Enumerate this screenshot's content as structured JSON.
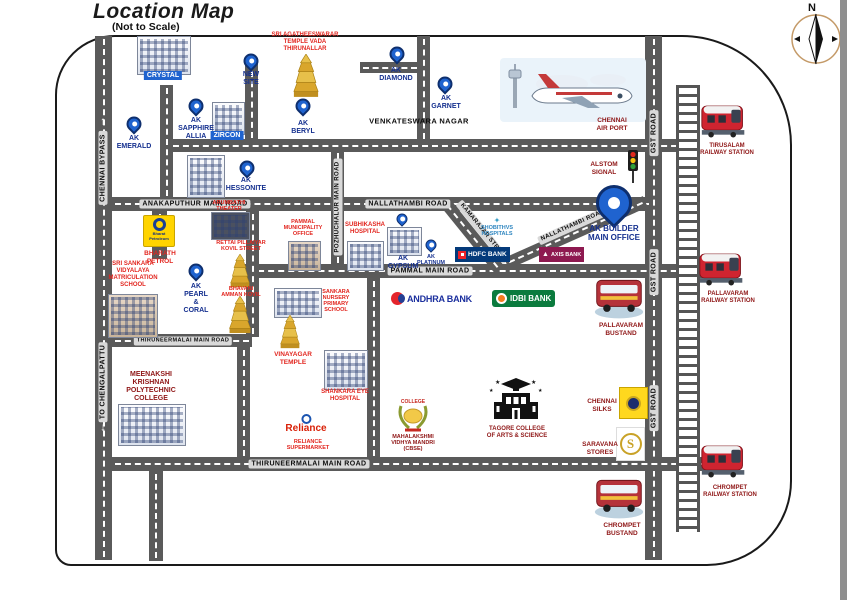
{
  "page": {
    "title": "Location Map",
    "subtitle": "(Not to Scale)"
  },
  "compass": {
    "n": "N"
  },
  "icons": {
    "arrow_up": "↑",
    "arrow_down": "↓",
    "axis_a": "▲",
    "saravana_s": "S",
    "shobithvs_diamond": "✦"
  },
  "colors": {
    "pin_blue": "#1f63cf",
    "label_navy": "#15308f",
    "bright_red": "#e2261f",
    "dark_red": "#8f1616",
    "road_gray": "#5a5a5a"
  },
  "roads": {
    "chennai_bypass": "CHENNAI BYPASS",
    "to_chengalpattu": "TO CHENGALPATTU",
    "gst_road": "GST ROAD",
    "anakaputhur": "ANAKAPUTHUR MAIN ROAD",
    "venkateswara_nagar": "VENKATESWARA NAGAR",
    "nallathambi_h": "NALLATHAMBI ROAD",
    "nallathambi_diag": "NALLATHAMBI ROAD",
    "kamarajar": "KAMARAJAR STREET",
    "pammal": "PAMMAL MAIN ROAD",
    "pozhuchalur": "POZHUCHALUR MAIN ROAD",
    "thiruneermalai_upper": "THIRUNEERMALAI MAIN ROAD",
    "thiruneermalai_lower": "THIRUNEERMALAI MAIN ROAD"
  },
  "projects": {
    "crystal": "CRYSTAL",
    "zircon": "ZIRCON",
    "new_site": "NEW\nSITE",
    "sapphire": "AK\nSAPPHIRE\nALLIA",
    "emerald": "AK\nEMERALD",
    "beryl": "AK\nBERYL",
    "diamond": "AK\nDIAMOND",
    "garnet": "AK\nGARNET",
    "hessonite": "AK\nHESSONITE",
    "pearl_coral": "AK\nPEARL\n&\nCORAL",
    "gypsum": "AK\nGYPSUM",
    "platinum": "AK\nPLATINUM",
    "builder_office": "AK BUILDER\nMAIN OFFICE"
  },
  "landmarks": {
    "agatheeswarar": "SRI AGATHEESWARAR\nTEMPLE VADA\nTHIRUNALLAR",
    "arumbathi": "ARUMBATHI\nTHEATER",
    "bharath_petrol": "BHARATH\nPETROL",
    "sankara_school": "SRI SANKARA\nVIDYALAYA\nMATRICULATION\nSCHOOL",
    "pammal_office": "PAMMAL\nMUNICIPALITY\nOFFICE",
    "subhikasha": "SUBHIKASHA\nHOSPITAL",
    "rettai": "RETTAI PILLAIYAR\nKOVIL STREET",
    "bhavani": "BHAVANI\nAMMAN KOVIL",
    "shobithvs": "SHOBITHVS\nHOSPITALS",
    "sankara_nursery": "SANKARA\nNURSERY\nPRIMARY\nSCHOOL",
    "vinayagar": "VINAYAGAR\nTEMPLE",
    "shankara_eye": "SHANKARA EYE\nHOSPITAL",
    "meenakshi": "MEENAKSHI\nKRISHNAN\nPOLYTECHNIC\nCOLLEGE",
    "reliance_label": "RELIANCE\nSUPERMARKET",
    "mahalakshmi": "MAHALAKSHMI\nVIDHYA MANDRI\n(CBSE)",
    "tagore": "TAGORE COLLEGE\nOF ARTS & SCIENCE",
    "chennai_silks": "CHENNAI\nSILKS",
    "saravana": "SARAVANA\nSTORES",
    "alstom": "ALSTOM\nSIGNAL",
    "airport": "CHENNAI\nAIR PORT",
    "tirusalam_rs": "TIRUSALAM\nRAILWAY STATION",
    "pallavaram_rs": "PALLAVARAM\nRAILWAY STATION",
    "chrompet_rs": "CHROMPET\nRAILWAY STATION",
    "pallavaram_bus": "PALLAVARAM\nBUSTAND",
    "chrompet_bus": "CHROMPET\nBUSTAND"
  },
  "logos": {
    "hdfc": "HDFC BANK",
    "axis": "AXIS BANK",
    "idbi": "IDBI BANK",
    "andhra": "ANDHRA BANK",
    "reliance": "Reliance",
    "bharat": "Bharat\nPetroleum"
  }
}
